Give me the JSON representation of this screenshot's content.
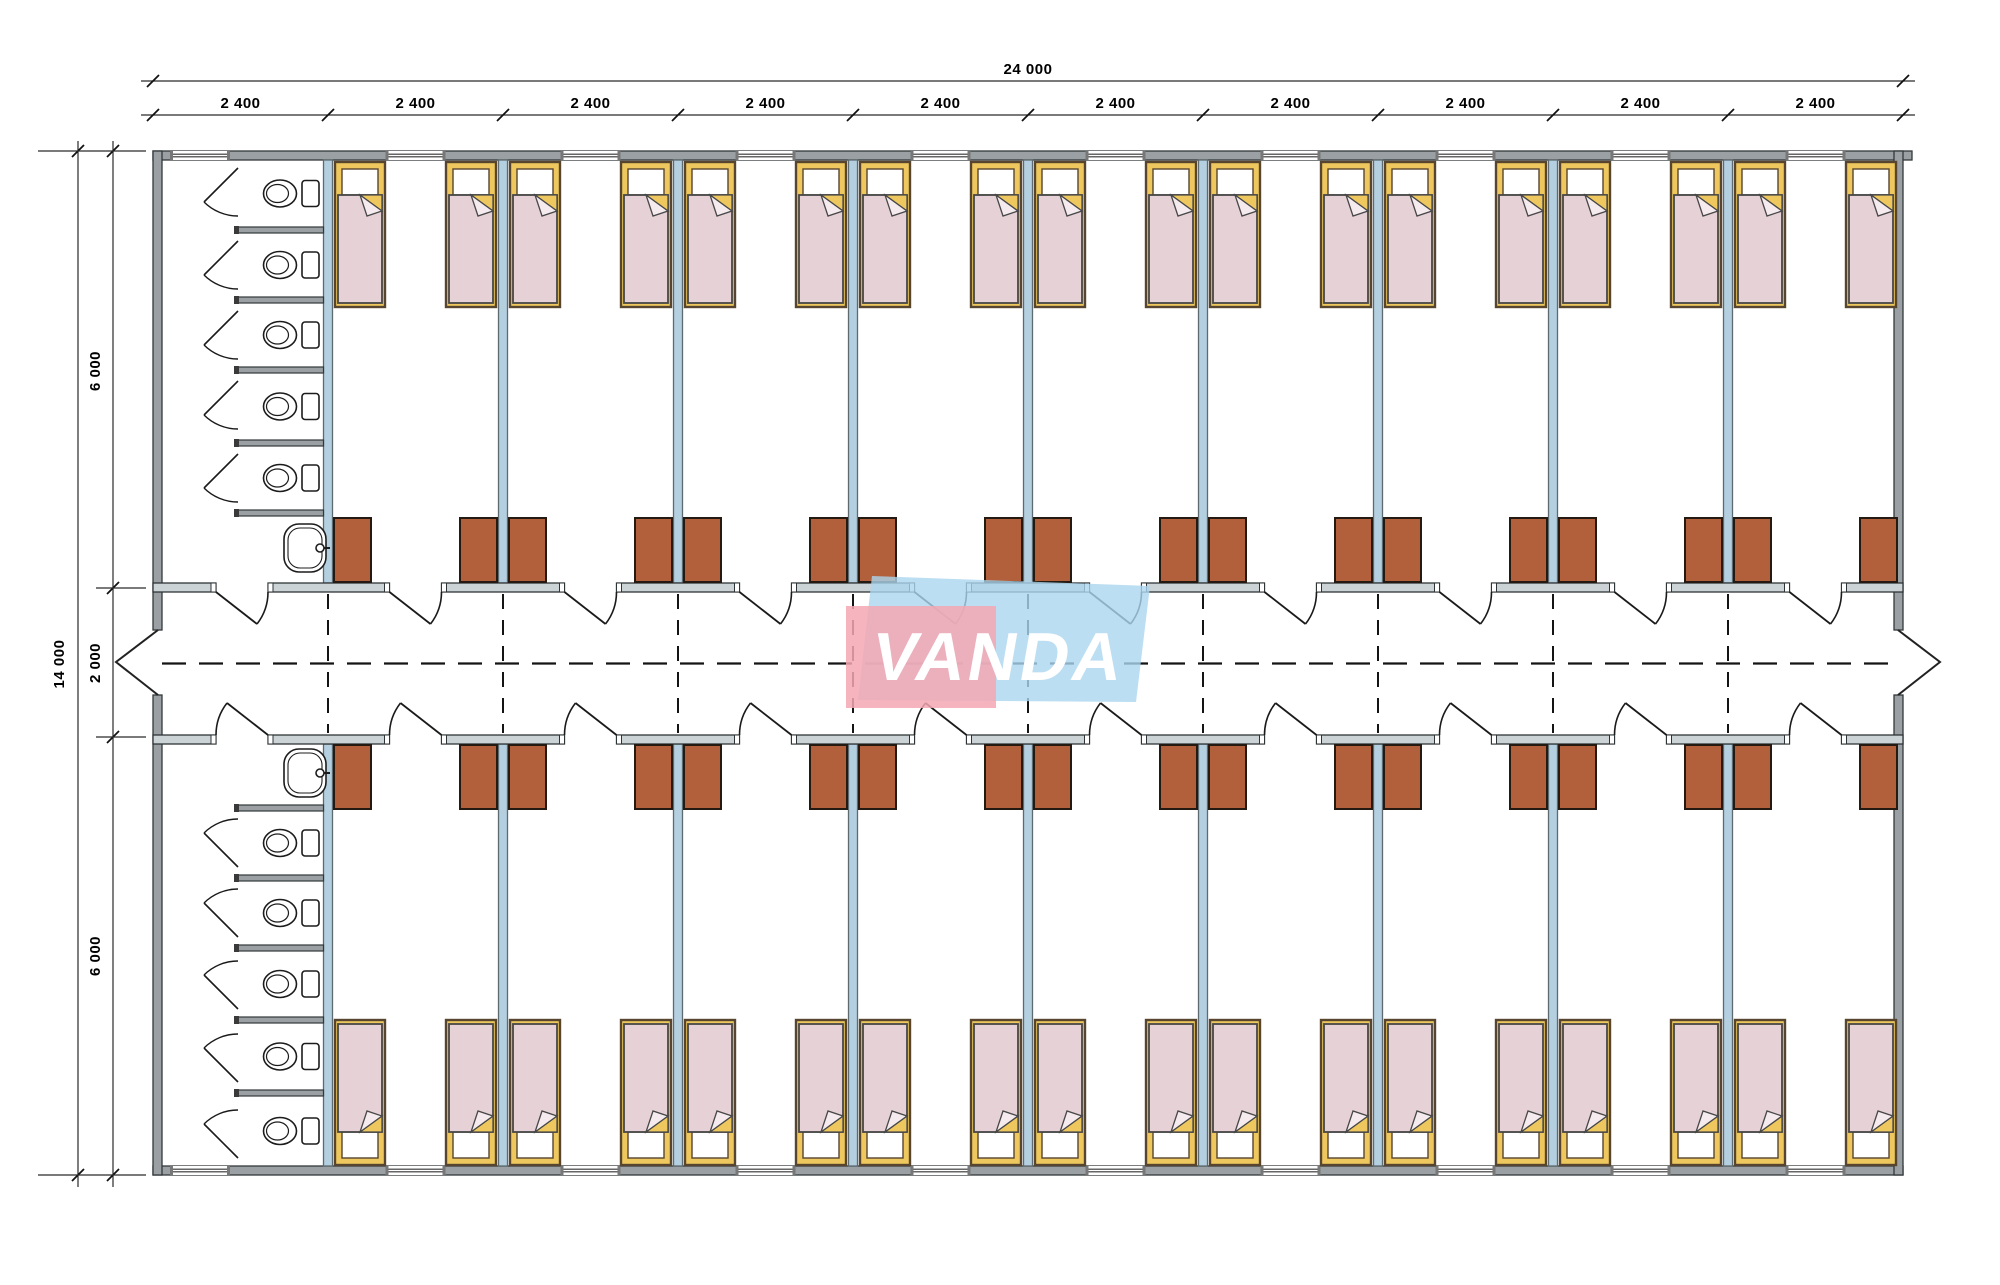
{
  "logo": {
    "text": "VANDA",
    "pink_color": "#f4a7b3",
    "blue_color": "#abd6ef",
    "text_color": "#ffffff"
  },
  "dimensions": {
    "total_width_label": "24 000",
    "module_labels": [
      "2 400",
      "2 400",
      "2 400",
      "2 400",
      "2 400",
      "2 400",
      "2 400",
      "2 400",
      "2 400",
      "2 400"
    ],
    "total_height_label": "14 000",
    "left_segment_labels": [
      "6 000",
      "2 000",
      "6 000"
    ]
  },
  "layout_counts": {
    "modules": 10,
    "rooms_top_wing": 9,
    "rooms_bottom_wing": 9,
    "beds_per_room": 2,
    "wardrobes_per_room": 2,
    "toilet_stalls_top": 5,
    "toilet_stalls_bottom": 5,
    "washbasins": 2
  },
  "colors": {
    "background": "#ffffff",
    "wall": "#9aa0a3",
    "wall_edge": "#33383a",
    "partition": "#b4cfe0",
    "partition_edge": "#5d6a70",
    "corridor_wall": "#ccd3d6",
    "corridor_wall_edge": "#2f3537",
    "bed_frame": "#eec85e",
    "bed_frame_edge": "#57452f",
    "pillow": "#ffffff",
    "blanket": "#e5d1d6",
    "blanket_edge": "#474747",
    "fold_flap": "#f5ebee",
    "wardrobe": "#b2603c",
    "wardrobe_edge": "#241a12",
    "fixture_line": "#1c1c1c",
    "dimension_line": "#2a2a2a",
    "centerline": "#141414",
    "text": "#000000"
  }
}
